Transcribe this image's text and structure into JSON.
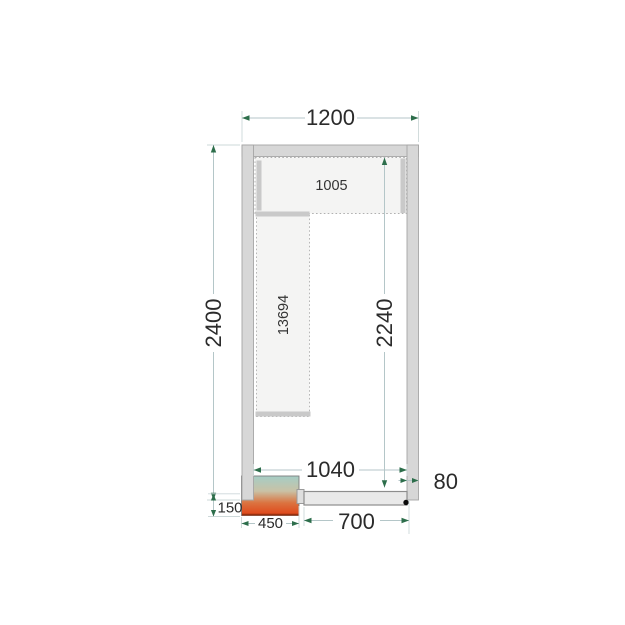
{
  "diagram": {
    "type": "cold-room-floor-plan",
    "dims": {
      "total_width": "1200",
      "total_height": "2400",
      "inner_width": "1040",
      "inner_height": "2240",
      "door_opening": "700",
      "unit_width": "450",
      "unit_protrusion": "150",
      "wall_thickness": "80"
    },
    "shelves": {
      "top_label": "1005",
      "left_label": "13694"
    },
    "colors": {
      "wall": "#d7d7d7",
      "shelf_fill": "#f4f4f3",
      "dim_line": "#b4c6c8",
      "arrow": "#2d6e4b",
      "text": "#2b2b2b",
      "door": "#e9e9e9",
      "unit_gradient_top": "#a5cdc5",
      "unit_gradient_bottom": "#e04316",
      "unit_bottom_edge": "#97300f"
    }
  }
}
